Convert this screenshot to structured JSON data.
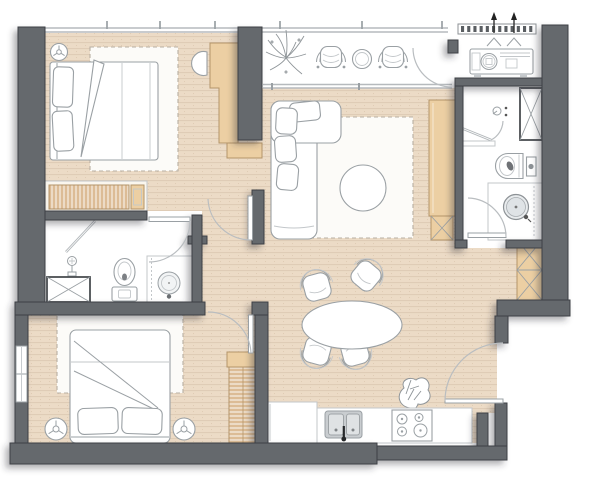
{
  "plan": {
    "kind": "apartment-floor-plan",
    "colors": {
      "wall": "#65696d",
      "wall-stroke": "#3e4144",
      "floor": "#ecdbc6",
      "floor-stripe": "#dfccb6",
      "rug": "#fcfbf8",
      "tan": "#eccfa3",
      "tan-stroke": "#b3946a",
      "louver": "#d8b58a",
      "line": "#9aa0a4",
      "line-light": "#c3c7ca",
      "dash": "#b8afa2",
      "dark": "#4a4e52",
      "arc": "#b9bdc0",
      "win": "#b6babd",
      "white": "#ffffff",
      "sink": "#c9cdd0",
      "basin": "#e9ecee",
      "plant": "#8e9498",
      "vent-dash": "#5a5e62",
      "arrow": "#222222",
      "faucet": "#26282a"
    },
    "rooms": [
      {
        "name": "bedroom-1",
        "furniture": [
          "ceiling-fan",
          "double-bed",
          "pillows",
          "rug",
          "desk",
          "desk-chair",
          "nightstand",
          "louver-radiator"
        ]
      },
      {
        "name": "balcony",
        "furniture": [
          "plant",
          "barrel-chair",
          "barrel-chair",
          "side-table"
        ]
      },
      {
        "name": "ac-ledge",
        "furniture": [
          "louver-vent",
          "airflow-arrows",
          "ac-outdoor-unit"
        ]
      },
      {
        "name": "living-room",
        "furniture": [
          "l-shaped-sofa",
          "cushions",
          "rug",
          "round-coffee-table",
          "tv-cabinet",
          "duct-shaft"
        ]
      },
      {
        "name": "bathroom-1",
        "furniture": [
          "shower-head",
          "shower-glass",
          "toilet",
          "round-basin",
          "vanity-counter",
          "duct-shaft"
        ]
      },
      {
        "name": "bathroom-2",
        "furniture": [
          "shower-mixer",
          "shower-glass",
          "bench",
          "toilet",
          "flush-panel",
          "round-basin",
          "vanity-counter",
          "duct-shaft",
          "duct-shaft"
        ]
      },
      {
        "name": "bedroom-2",
        "furniture": [
          "double-bed",
          "pillows",
          "rug",
          "ceiling-fan",
          "ceiling-fan",
          "louver-wardrobe",
          "windows"
        ]
      },
      {
        "name": "dining-area",
        "furniture": [
          "oval-table",
          "chair",
          "chair",
          "chair",
          "chair",
          "plant"
        ]
      },
      {
        "name": "kitchen",
        "furniture": [
          "tall-cabinet",
          "counter",
          "double-sink",
          "faucet",
          "cooktop-4-burner"
        ]
      },
      {
        "name": "entry",
        "furniture": [
          "entry-door",
          "shoe-niche"
        ]
      }
    ],
    "doors": [
      "bedroom-1-door",
      "bedroom-2-door",
      "bathroom-1-door",
      "bathroom-2-door",
      "balcony-door",
      "entry-door"
    ],
    "icons": [
      "ceiling-fan-icon",
      "shower-head-icon",
      "toilet-icon",
      "basin-icon",
      "cooktop-icon",
      "sink-icon",
      "plant-icon",
      "ac-unit-icon",
      "vent-arrow-icon",
      "duct-x-icon"
    ]
  }
}
